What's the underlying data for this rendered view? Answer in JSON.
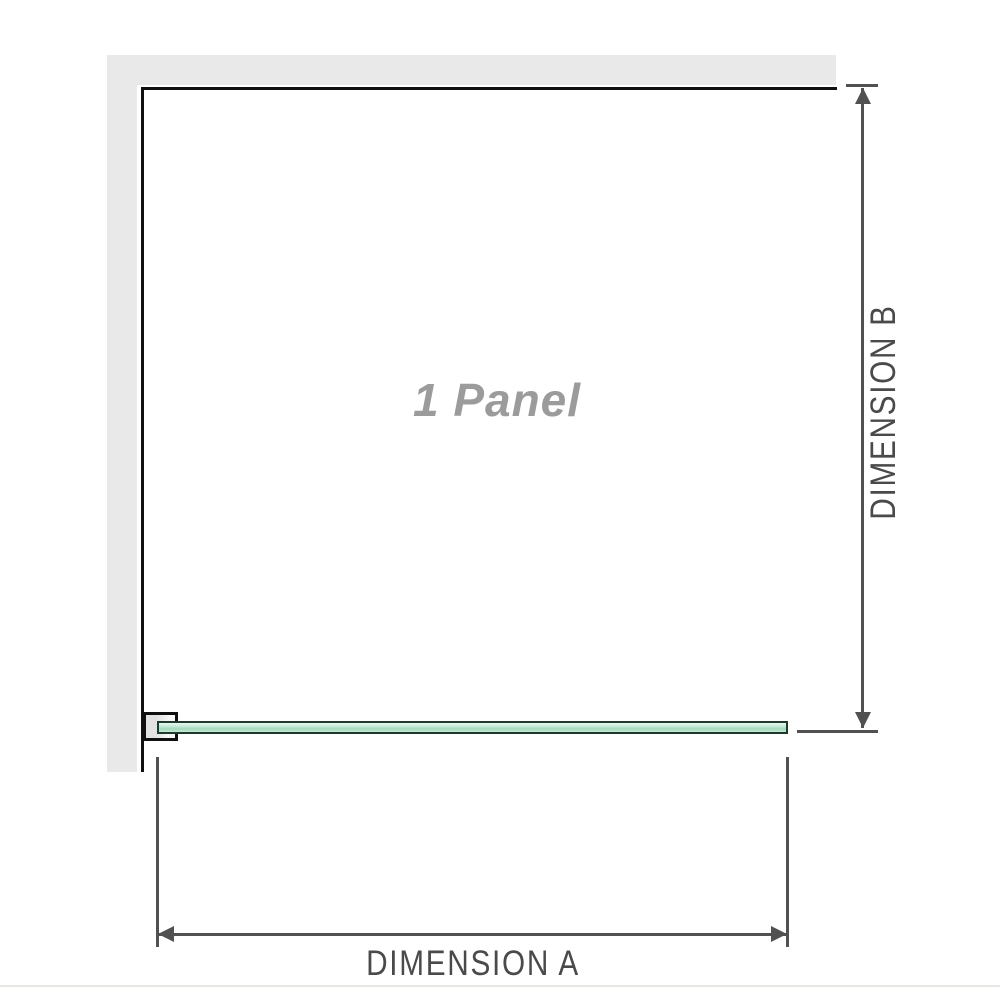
{
  "diagram": {
    "panel_label": "1 Panel",
    "dimension_a": {
      "label": "DIMENSION A"
    },
    "dimension_b": {
      "label": "DIMENSION B"
    }
  },
  "colors": {
    "background": "#ffffff",
    "wall_fill": "#e9e9e9",
    "outline": "#101010",
    "dimension": "#515151",
    "dimension_text": "#4a4a4a",
    "glass_border": "#1e3a2c",
    "glass_top": "#eaf7f0",
    "glass_light": "#cdeedd",
    "glass_mid": "#a3d9bd",
    "glass_low": "#c6e9d5",
    "bracket_fill_dark": "#e2e2e2",
    "bracket_fill_light": "#fafafa",
    "panel_text": "#9b9b9b",
    "edge_rule": "#e7e7e3"
  }
}
